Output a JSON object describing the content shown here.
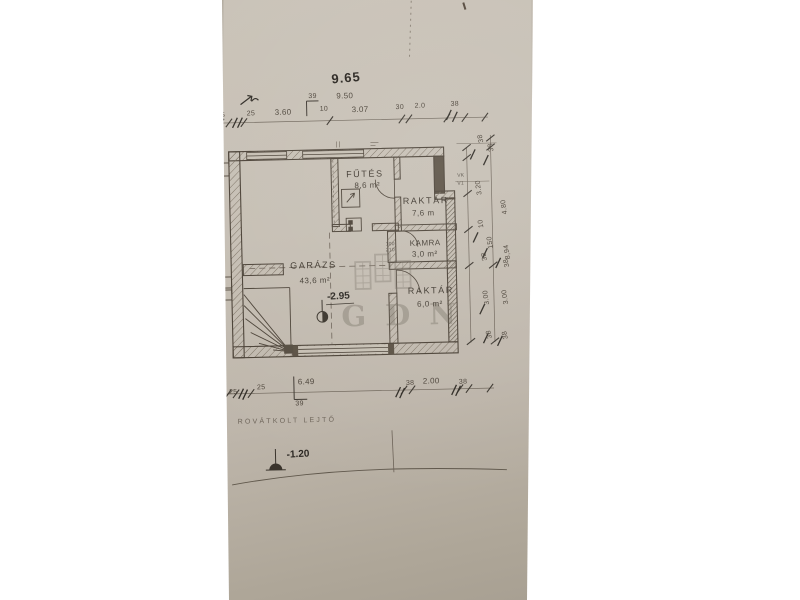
{
  "scene": {
    "background": "#ffffff",
    "paper_top_color": "#cac3b8",
    "paper_bottom_color": "#a39b8e",
    "ink_color": "#4a4136",
    "handwriting_color": "#2e2a24",
    "watermark_color": "#6e665c"
  },
  "watermark": {
    "text": "GDN"
  },
  "floorplan": {
    "rooms": [
      {
        "name": "FŰTÉS",
        "area": "8,6 m²"
      },
      {
        "name": "RAKTÁR",
        "area": "7,6 m"
      },
      {
        "name": "KAMRA",
        "area": "3,0 m²"
      },
      {
        "name": "GARÁZS",
        "area": "43,6 m²"
      },
      {
        "name": "RAKTÁR",
        "area": "6,0 m²"
      }
    ],
    "levels": {
      "garage_floor": "-2.95",
      "terrain": "-1.20"
    },
    "note": "ROVÁTKOLT LEJTŐ",
    "dimensions": {
      "top_total_handwritten": "9.65",
      "top_total_printed": "9.50",
      "top_chain": [
        "25",
        "25",
        "3.60",
        "39",
        "10",
        "3.07",
        "30",
        "2.0",
        "38"
      ],
      "right_chain": [
        "38",
        "38",
        "3.20",
        "4.80",
        "10",
        "150",
        "38",
        "8,94",
        "38",
        "3.00",
        "3.00",
        "38",
        "38"
      ],
      "bottom_chain": [
        "25",
        "25",
        "6.49",
        "39",
        "38",
        "2.00",
        "38"
      ],
      "flue_tags": [
        "VK",
        "V1"
      ],
      "door_tag": [
        "100",
        "210"
      ]
    }
  },
  "labels": [
    {
      "t": "9.65",
      "x": 336,
      "y": 72,
      "cls": "handbig",
      "rot": -4,
      "name": "dim-total-handwritten"
    },
    {
      "t": "9.50",
      "x": 341,
      "y": 92,
      "cls": "dimb",
      "name": "dim-total-printed"
    },
    {
      "t": "25",
      "x": 221,
      "y": 109,
      "cls": "dim",
      "name": "dim-top"
    },
    {
      "t": "25",
      "x": 251,
      "y": 108,
      "cls": "dim",
      "name": "dim-top"
    },
    {
      "t": "3.60",
      "x": 279,
      "y": 107,
      "cls": "dimb",
      "name": "dim-top"
    },
    {
      "t": "39",
      "x": 313,
      "y": 92,
      "cls": "dim",
      "name": "dim-top"
    },
    {
      "t": "10",
      "x": 324,
      "y": 105,
      "cls": "dim",
      "name": "dim-top"
    },
    {
      "t": "3.07",
      "x": 356,
      "y": 106,
      "cls": "dimb",
      "name": "dim-top"
    },
    {
      "t": "30",
      "x": 400,
      "y": 105,
      "cls": "dim",
      "name": "dim-top"
    },
    {
      "t": "2.0",
      "x": 419,
      "y": 104,
      "cls": "dim",
      "name": "dim-top"
    },
    {
      "t": "38",
      "x": 455,
      "y": 103,
      "cls": "dim",
      "name": "dim-top"
    },
    {
      "t": "38",
      "x": 482,
      "y": 146,
      "cls": "dim",
      "rot": -100,
      "name": "dim-right"
    },
    {
      "t": "38",
      "x": 492,
      "y": 155,
      "cls": "dim",
      "rot": -100,
      "name": "dim-right"
    },
    {
      "t": "3.20",
      "x": 479,
      "y": 198,
      "cls": "dim",
      "rot": -97,
      "name": "dim-right"
    },
    {
      "t": "4.80",
      "x": 504,
      "y": 218,
      "cls": "dim",
      "rot": -97,
      "name": "dim-right"
    },
    {
      "t": "10",
      "x": 480,
      "y": 231,
      "cls": "dim",
      "rot": -97,
      "name": "dim-right"
    },
    {
      "t": "150",
      "x": 489,
      "y": 252,
      "cls": "dim",
      "rot": -97,
      "name": "dim-right"
    },
    {
      "t": "38",
      "x": 483,
      "y": 264,
      "cls": "dim",
      "rot": -100,
      "name": "dim-right"
    },
    {
      "t": "8,94",
      "x": 506,
      "y": 263,
      "cls": "dim",
      "rot": -97,
      "name": "dim-right"
    },
    {
      "t": "38",
      "x": 505,
      "y": 271,
      "cls": "dim",
      "rot": -100,
      "name": "dim-right"
    },
    {
      "t": "3.00",
      "x": 484,
      "y": 308,
      "cls": "dim",
      "rot": -97,
      "name": "dim-right"
    },
    {
      "t": "3.00",
      "x": 503,
      "y": 308,
      "cls": "dim",
      "rot": -97,
      "name": "dim-right"
    },
    {
      "t": "38",
      "x": 486,
      "y": 342,
      "cls": "dim",
      "rot": -100,
      "name": "dim-right"
    },
    {
      "t": "38",
      "x": 502,
      "y": 343,
      "cls": "dim",
      "rot": -100,
      "name": "dim-right"
    },
    {
      "t": "25",
      "x": 227,
      "y": 386,
      "cls": "dim",
      "name": "dim-bottom"
    },
    {
      "t": "25",
      "x": 255,
      "y": 382,
      "cls": "dim",
      "name": "dim-bottom"
    },
    {
      "t": "6.49",
      "x": 296,
      "y": 377,
      "cls": "dimb",
      "name": "dim-bottom"
    },
    {
      "t": "39",
      "x": 293,
      "y": 399,
      "cls": "dim",
      "name": "dim-bottom"
    },
    {
      "t": "38",
      "x": 404,
      "y": 381,
      "cls": "dim",
      "name": "dim-bottom"
    },
    {
      "t": "2.00",
      "x": 421,
      "y": 379,
      "cls": "dimb",
      "name": "dim-bottom"
    },
    {
      "t": "38",
      "x": 457,
      "y": 381,
      "cls": "dim",
      "name": "dim-bottom"
    },
    {
      "t": "FŰTÉS",
      "x": 349,
      "y": 170,
      "cls": "room",
      "name": "room-label-futes"
    },
    {
      "t": "8,6 m²",
      "x": 357,
      "y": 182,
      "cls": "area",
      "name": "room-area-futes"
    },
    {
      "t": "RAKTÁR",
      "x": 405,
      "y": 198,
      "cls": "room",
      "name": "room-label-raktar-1"
    },
    {
      "t": "7,6 m",
      "x": 414,
      "y": 211,
      "cls": "area",
      "name": "room-area-raktar-1"
    },
    {
      "t": "KAMRA",
      "x": 411,
      "y": 241,
      "cls": "area",
      "name": "room-label-kamra"
    },
    {
      "t": "3,0 m²",
      "x": 413,
      "y": 252,
      "cls": "area",
      "name": "room-area-kamra"
    },
    {
      "t": "GARÁZS",
      "x": 291,
      "y": 260,
      "cls": "room",
      "name": "room-label-garazs"
    },
    {
      "t": "43,6 m²",
      "x": 300,
      "y": 276,
      "cls": "area",
      "name": "room-area-garazs"
    },
    {
      "t": "RAKTÁR",
      "x": 408,
      "y": 288,
      "cls": "room",
      "name": "room-label-raktar-2"
    },
    {
      "t": "6,0 m²",
      "x": 417,
      "y": 302,
      "cls": "area",
      "name": "room-area-raktar-2"
    },
    {
      "t": "-2.95",
      "x": 327,
      "y": 292,
      "cls": "lvl",
      "rot": -2,
      "name": "level-garage"
    },
    {
      "t": "-1.20",
      "x": 283,
      "y": 449,
      "cls": "lvl",
      "rot": -2,
      "name": "level-terrain"
    },
    {
      "t": "ROVÁTKOLT LEJTŐ",
      "x": 235,
      "y": 416,
      "cls": "note",
      "name": "slope-note"
    },
    {
      "t": "VK",
      "x": 460,
      "y": 176,
      "cls": "tiny",
      "name": "flue-tag"
    },
    {
      "t": "V1",
      "x": 460,
      "y": 184,
      "cls": "tiny",
      "name": "flue-tag"
    },
    {
      "t": "100",
      "x": 387,
      "y": 243,
      "cls": "tiny",
      "name": "door-size-tag"
    },
    {
      "t": "210",
      "x": 387,
      "y": 249,
      "cls": "tiny",
      "name": "door-size-tag"
    }
  ]
}
